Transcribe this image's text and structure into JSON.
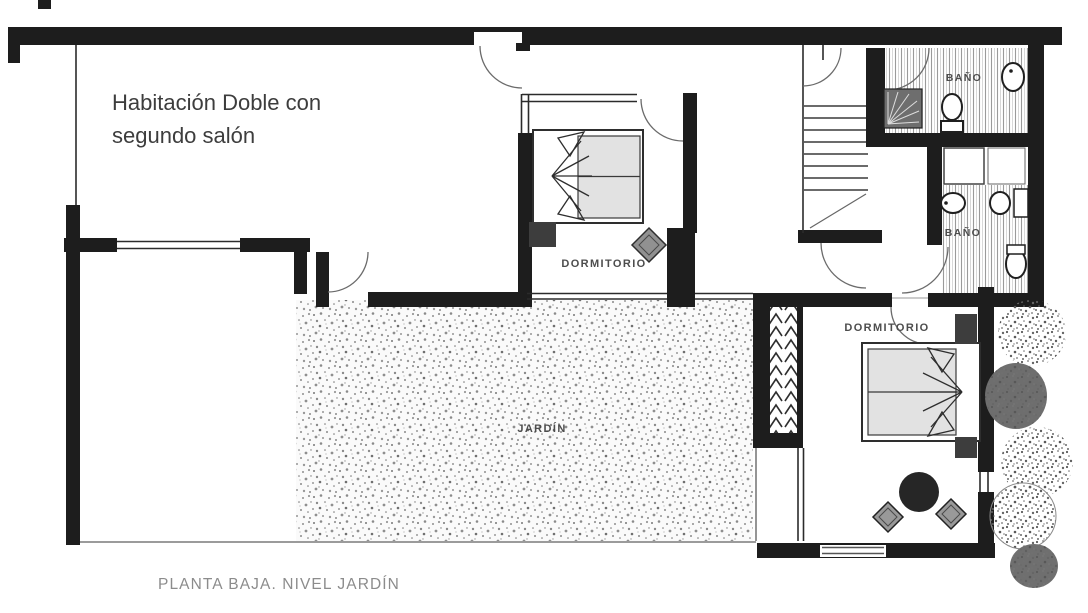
{
  "annotation": {
    "line1": "Habitación Doble con",
    "line2": "segundo salón"
  },
  "rooms": {
    "bedroom_top": {
      "label": "DORMITORIO"
    },
    "bedroom_right": {
      "label": "DORMITORIO"
    },
    "bathroom_top": {
      "label": "BAÑO"
    },
    "bathroom_lower": {
      "label": "BAÑO"
    },
    "garden": {
      "label": "JARDÍN"
    }
  },
  "caption": "PLANTA BAJA. NIVEL JARDÍN",
  "colors": {
    "walls": "#1d1d1d",
    "room_label": "#4d4d4d",
    "caption_text": "#8c8c8c",
    "annotation_text": "#3d3d3d",
    "mattress": "#e2e2e2",
    "garden_background": "#fafafa",
    "background": "#ffffff"
  }
}
